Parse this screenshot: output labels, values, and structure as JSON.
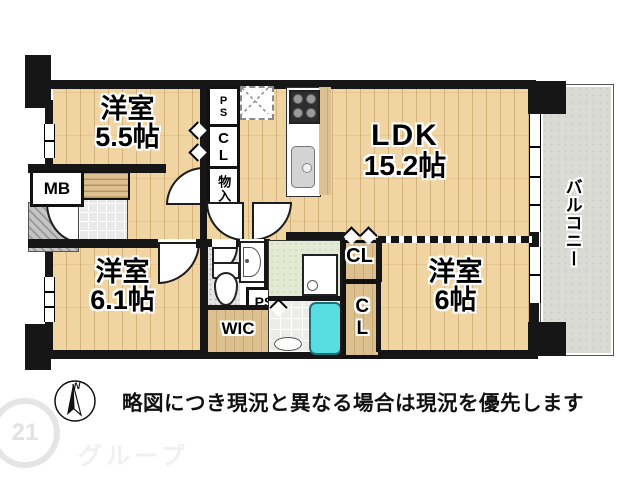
{
  "floorplan": {
    "rooms": [
      {
        "id": "room-55",
        "name": "洋室",
        "area": "5.5帖"
      },
      {
        "id": "ldk",
        "name": "LDK",
        "area": "15.2帖"
      },
      {
        "id": "room-61",
        "name": "洋室",
        "area": "6.1帖"
      },
      {
        "id": "room-6",
        "name": "洋室",
        "area": "6帖"
      }
    ],
    "balcony_label": "バルコニー",
    "labels": {
      "wic": "WIC",
      "cl_hall": "CL",
      "cl_top": "CL",
      "cl_side": "CL",
      "monoire": "物入",
      "ps_top": "PS",
      "ps_mid": "PS",
      "mb": "MB"
    },
    "compass": {
      "north": "N"
    }
  },
  "footer": {
    "disclaimer": "略図につき現況と異なる場合は現況を優先します"
  },
  "watermark": {
    "badge": "21",
    "text": "グループ"
  },
  "colors": {
    "wood": "#f0d5a2",
    "closet_wood": "#ddc08f",
    "balcony": "#dbdbd5",
    "bathtub": "#57dde2",
    "washroom": "#e3e9d3",
    "wall": "#161616"
  }
}
